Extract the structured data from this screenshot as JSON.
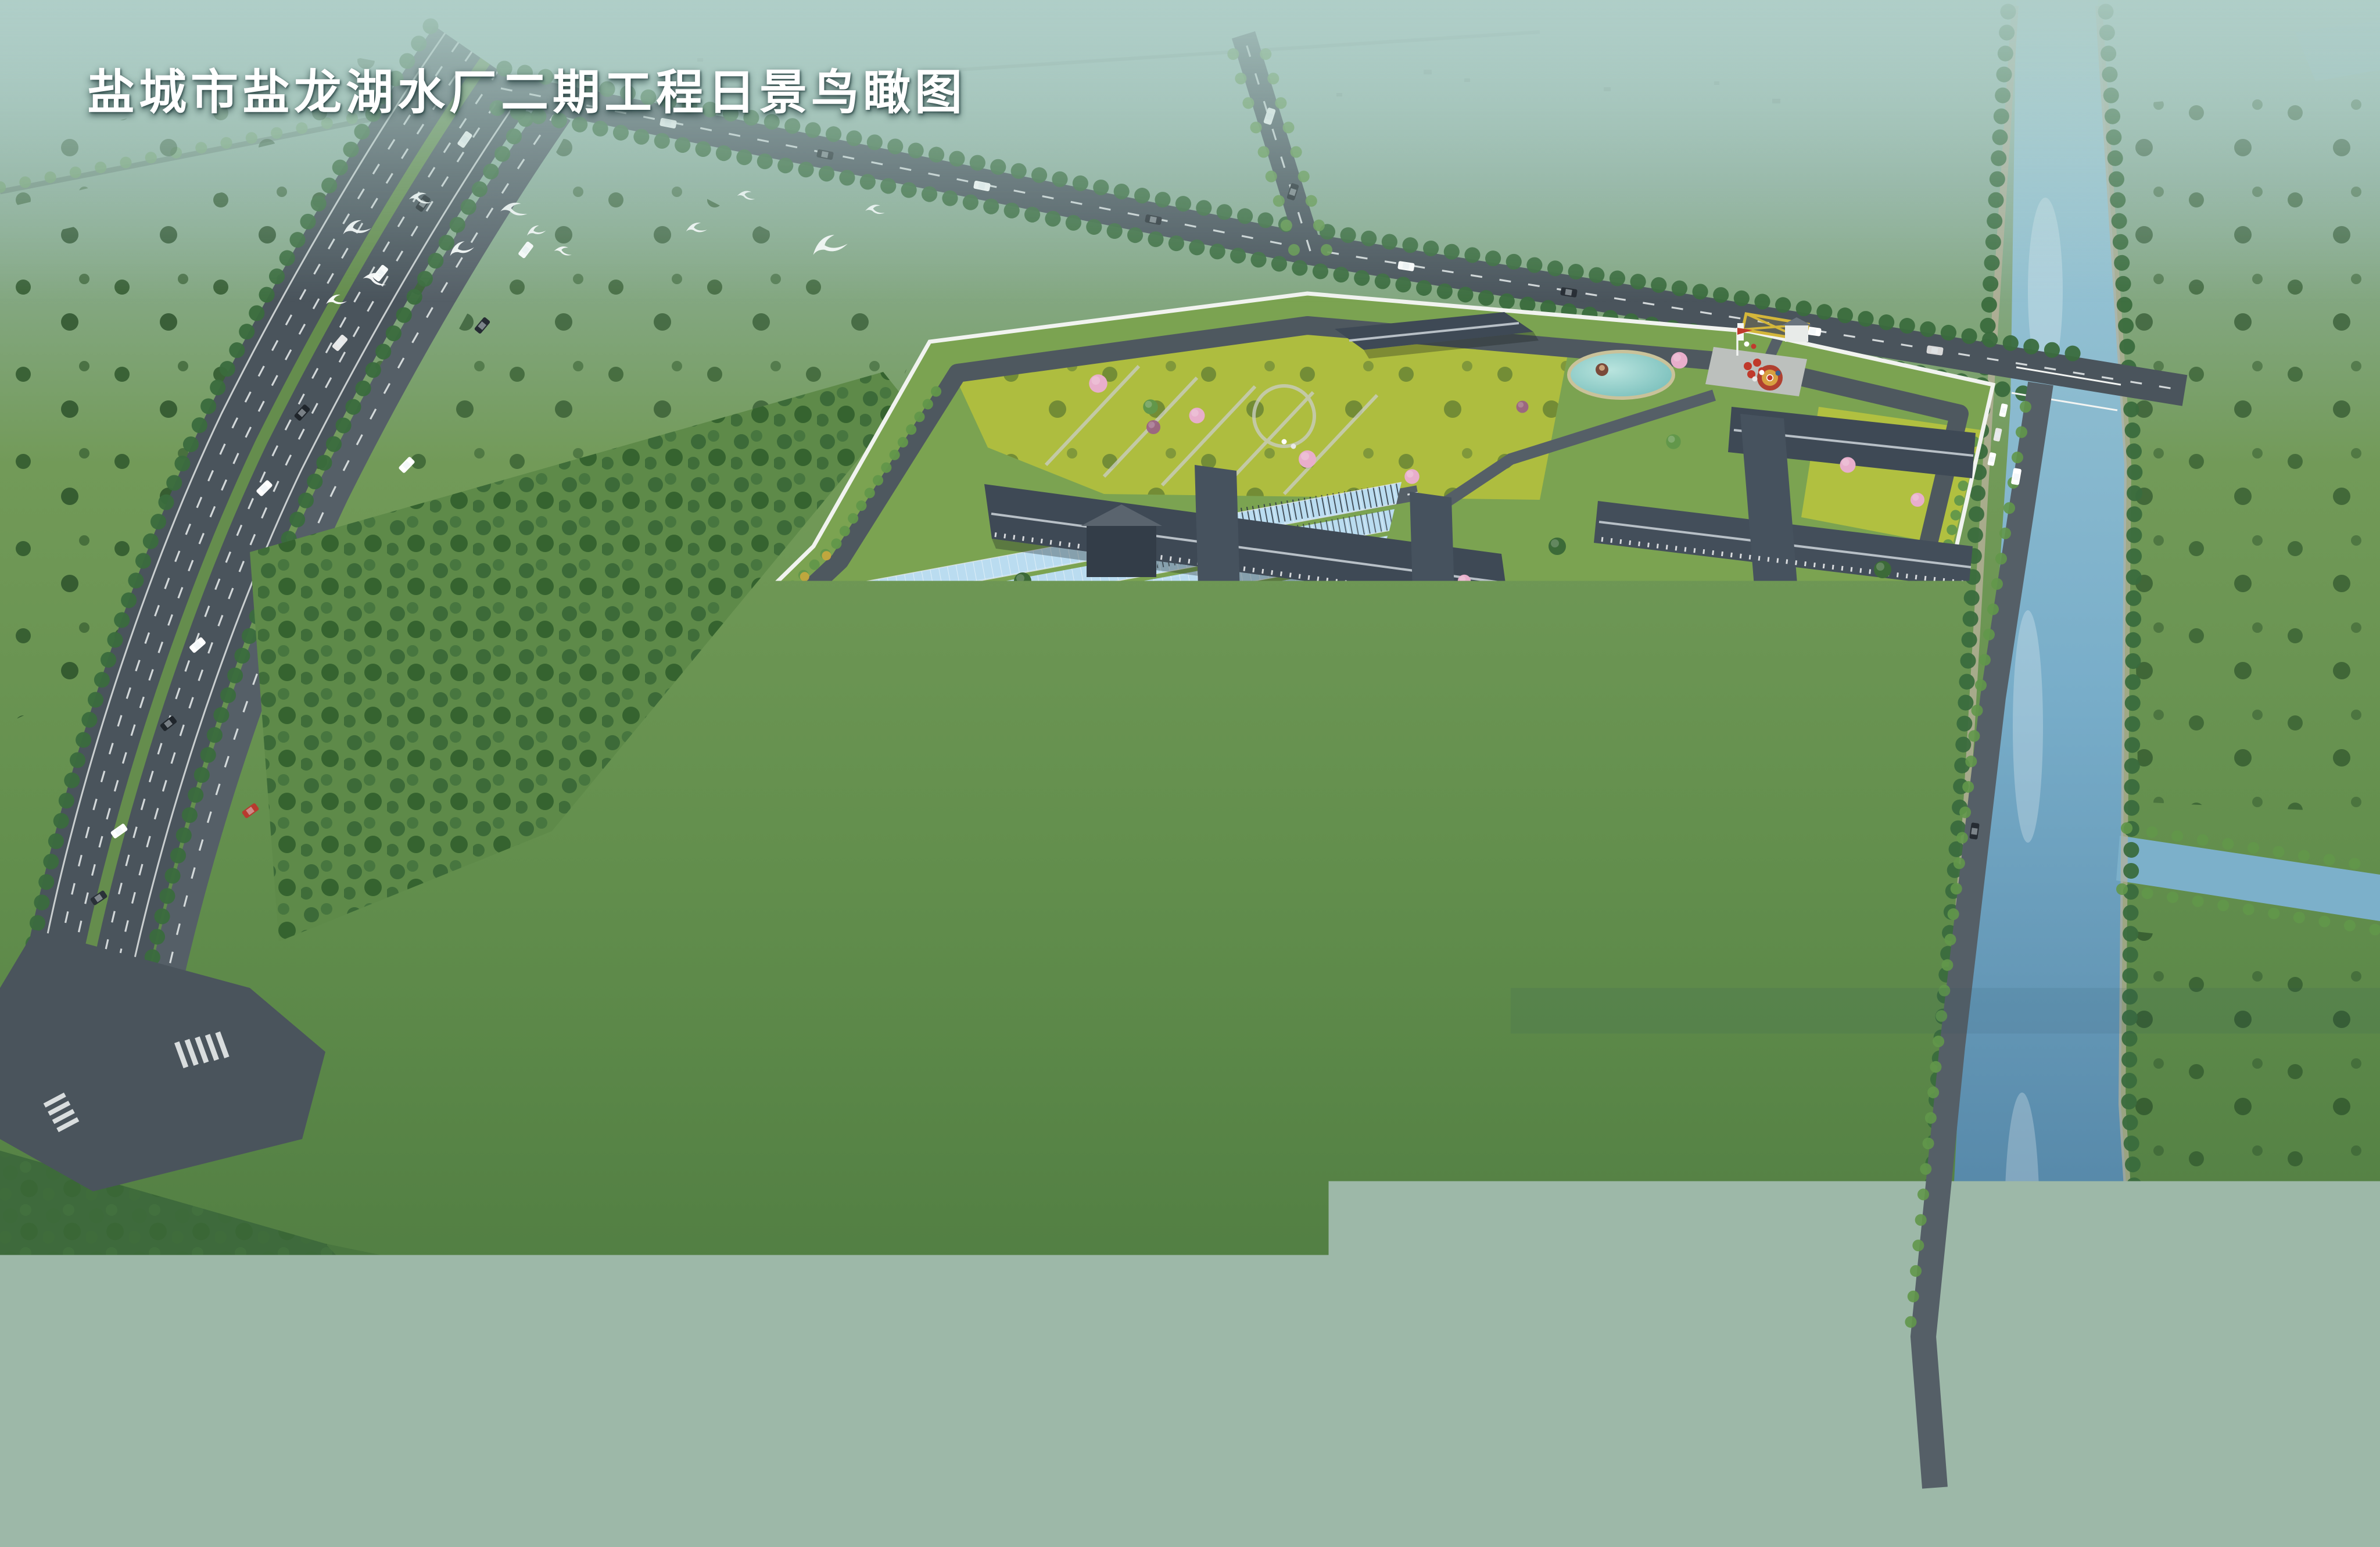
{
  "title": {
    "text": "盐城市盐龙湖水厂二期工程日景鸟瞰图"
  },
  "scene": {
    "kind": "aerial-architectural-rendering",
    "subject": "water treatment plant campus with treatment halls, sedimentation tanks, gardens, pond, plaza, perimeter wall, highway, canal and flying egrets"
  },
  "colors": {
    "bg_top": "#a6c9c3",
    "bg_up": "#85a896",
    "field": "#6e9455",
    "field_light": "#7da75c",
    "field_dark": "#45743f",
    "forest": "#3c6a38",
    "tree": "#3a6b3d",
    "tree_light": "#62974a",
    "road": "#4a545c",
    "road2": "#555f67",
    "marking": "#eaeeee",
    "median": "#66904c",
    "sand": "#c8c09a",
    "wall": "#f1f3ef",
    "lawn": "#7ba351",
    "flower": "#b4c23f",
    "flower2": "#d6cd3e",
    "glass": "#badcf0",
    "glass2": "#8fc3e4",
    "water": "#a8d4e6",
    "canal_top": "#a5ced8",
    "canal_mid": "#78adc9",
    "canal_deep": "#497c9e",
    "roof": "#3e4955",
    "roof_light": "#97a1ab",
    "ridge": "#b8c0c7",
    "charcoal": "#2d3742",
    "concrete": "#b3b9bd",
    "wall_bldg": "#4a5560",
    "white": "#f8fafa",
    "pink": "#e8aecb",
    "orange": "#d9913a",
    "gold": "#c9a83d",
    "red": "#c03a2e",
    "yellow_mark": "#d4b63a"
  }
}
